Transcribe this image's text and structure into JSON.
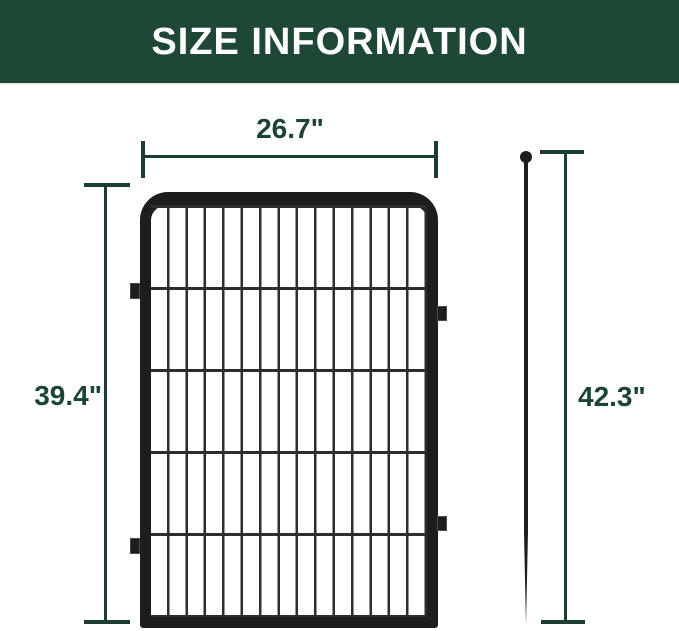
{
  "header": {
    "title": "SIZE INFORMATION"
  },
  "figure": {
    "panel": {
      "width_label": "26.7\"",
      "height_label": "39.4\""
    },
    "stake": {
      "height_label": "42.3\""
    }
  },
  "colors": {
    "header_bg": "#1f4736",
    "header_text": "#ffffff",
    "dimension": "#1c3e30",
    "label_text": "#1c4434",
    "fence": "#1d1d1d",
    "wire": "#2d2d2d",
    "background": "#ffffff"
  }
}
